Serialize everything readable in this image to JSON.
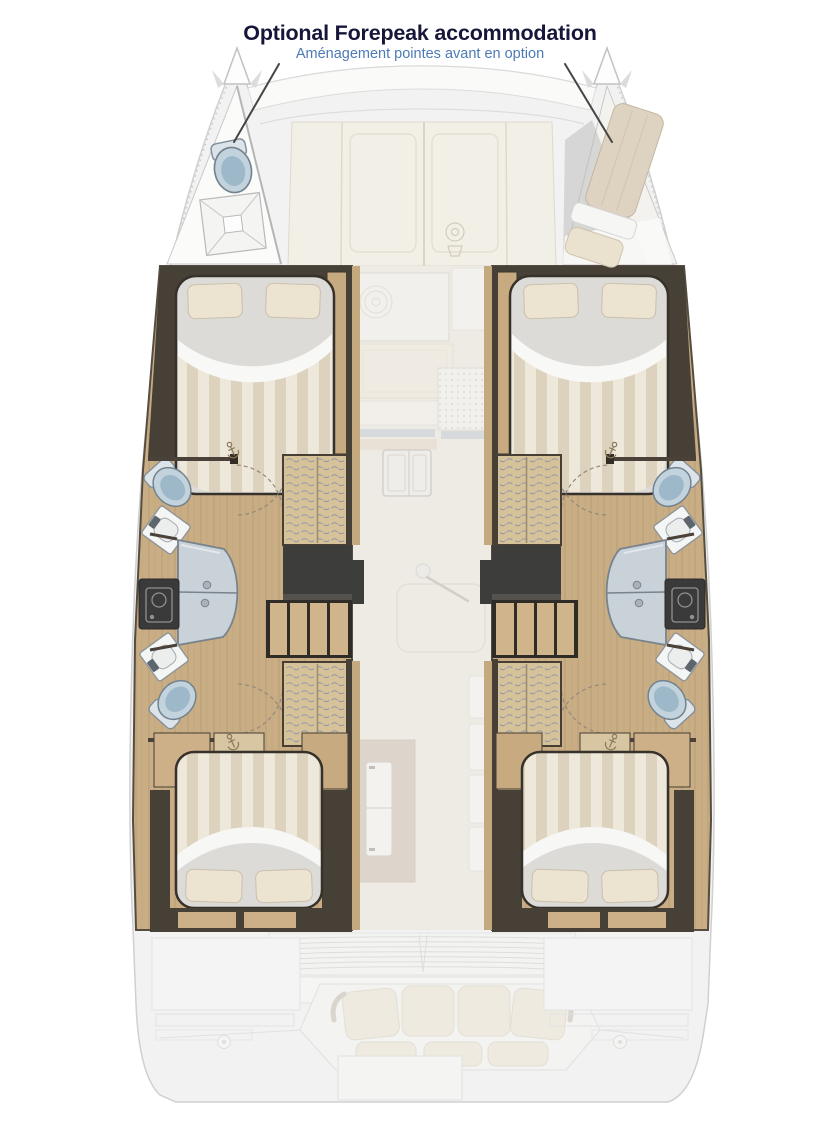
{
  "annotation": {
    "title": "Optional Forepeak accommodation",
    "subtitle": "Aménagement pointes avant en option"
  },
  "colors": {
    "title_text": "#16163a",
    "subtitle_text": "#4d7ab5",
    "arrow": "#454545",
    "hull_floor": "#c9ad84",
    "dark_wall": "#464036",
    "bed_duvet": "#e9e2d2",
    "bed_stripe": "#dcd2bd",
    "pillow": "#ece4d1",
    "toilet": "#c2d3de",
    "shower_glass": "#c9d2d9",
    "locker_weave": "#d5c299",
    "landing_dark": "#3d3d3c",
    "foredeck_panel": "#f3efe6",
    "exterior_deck": "#f2f2f2",
    "saloon_floor": "#eeebe5",
    "cushion": "#ece4d2"
  },
  "diagram": {
    "type": "catamaran-deck-plan",
    "view": "top",
    "highlighted_option": "forepeak-accommodation",
    "port_forepeak_fixtures": [
      "toilet",
      "shower-tray"
    ],
    "starboard_forepeak_fixtures": [
      "single-berth",
      "pillow"
    ],
    "hull_fixtures": [
      "forward-double-berth",
      "toilet",
      "washbasin",
      "shower-cubicle",
      "washer",
      "aft-double-berth",
      "companionway-steps",
      "cane-front-lockers"
    ],
    "nacelle_fixtures": [
      "galley-stove",
      "galley-sink",
      "saloon-table",
      "refrigerator",
      "cockpit-sofa",
      "aft-grating"
    ]
  }
}
